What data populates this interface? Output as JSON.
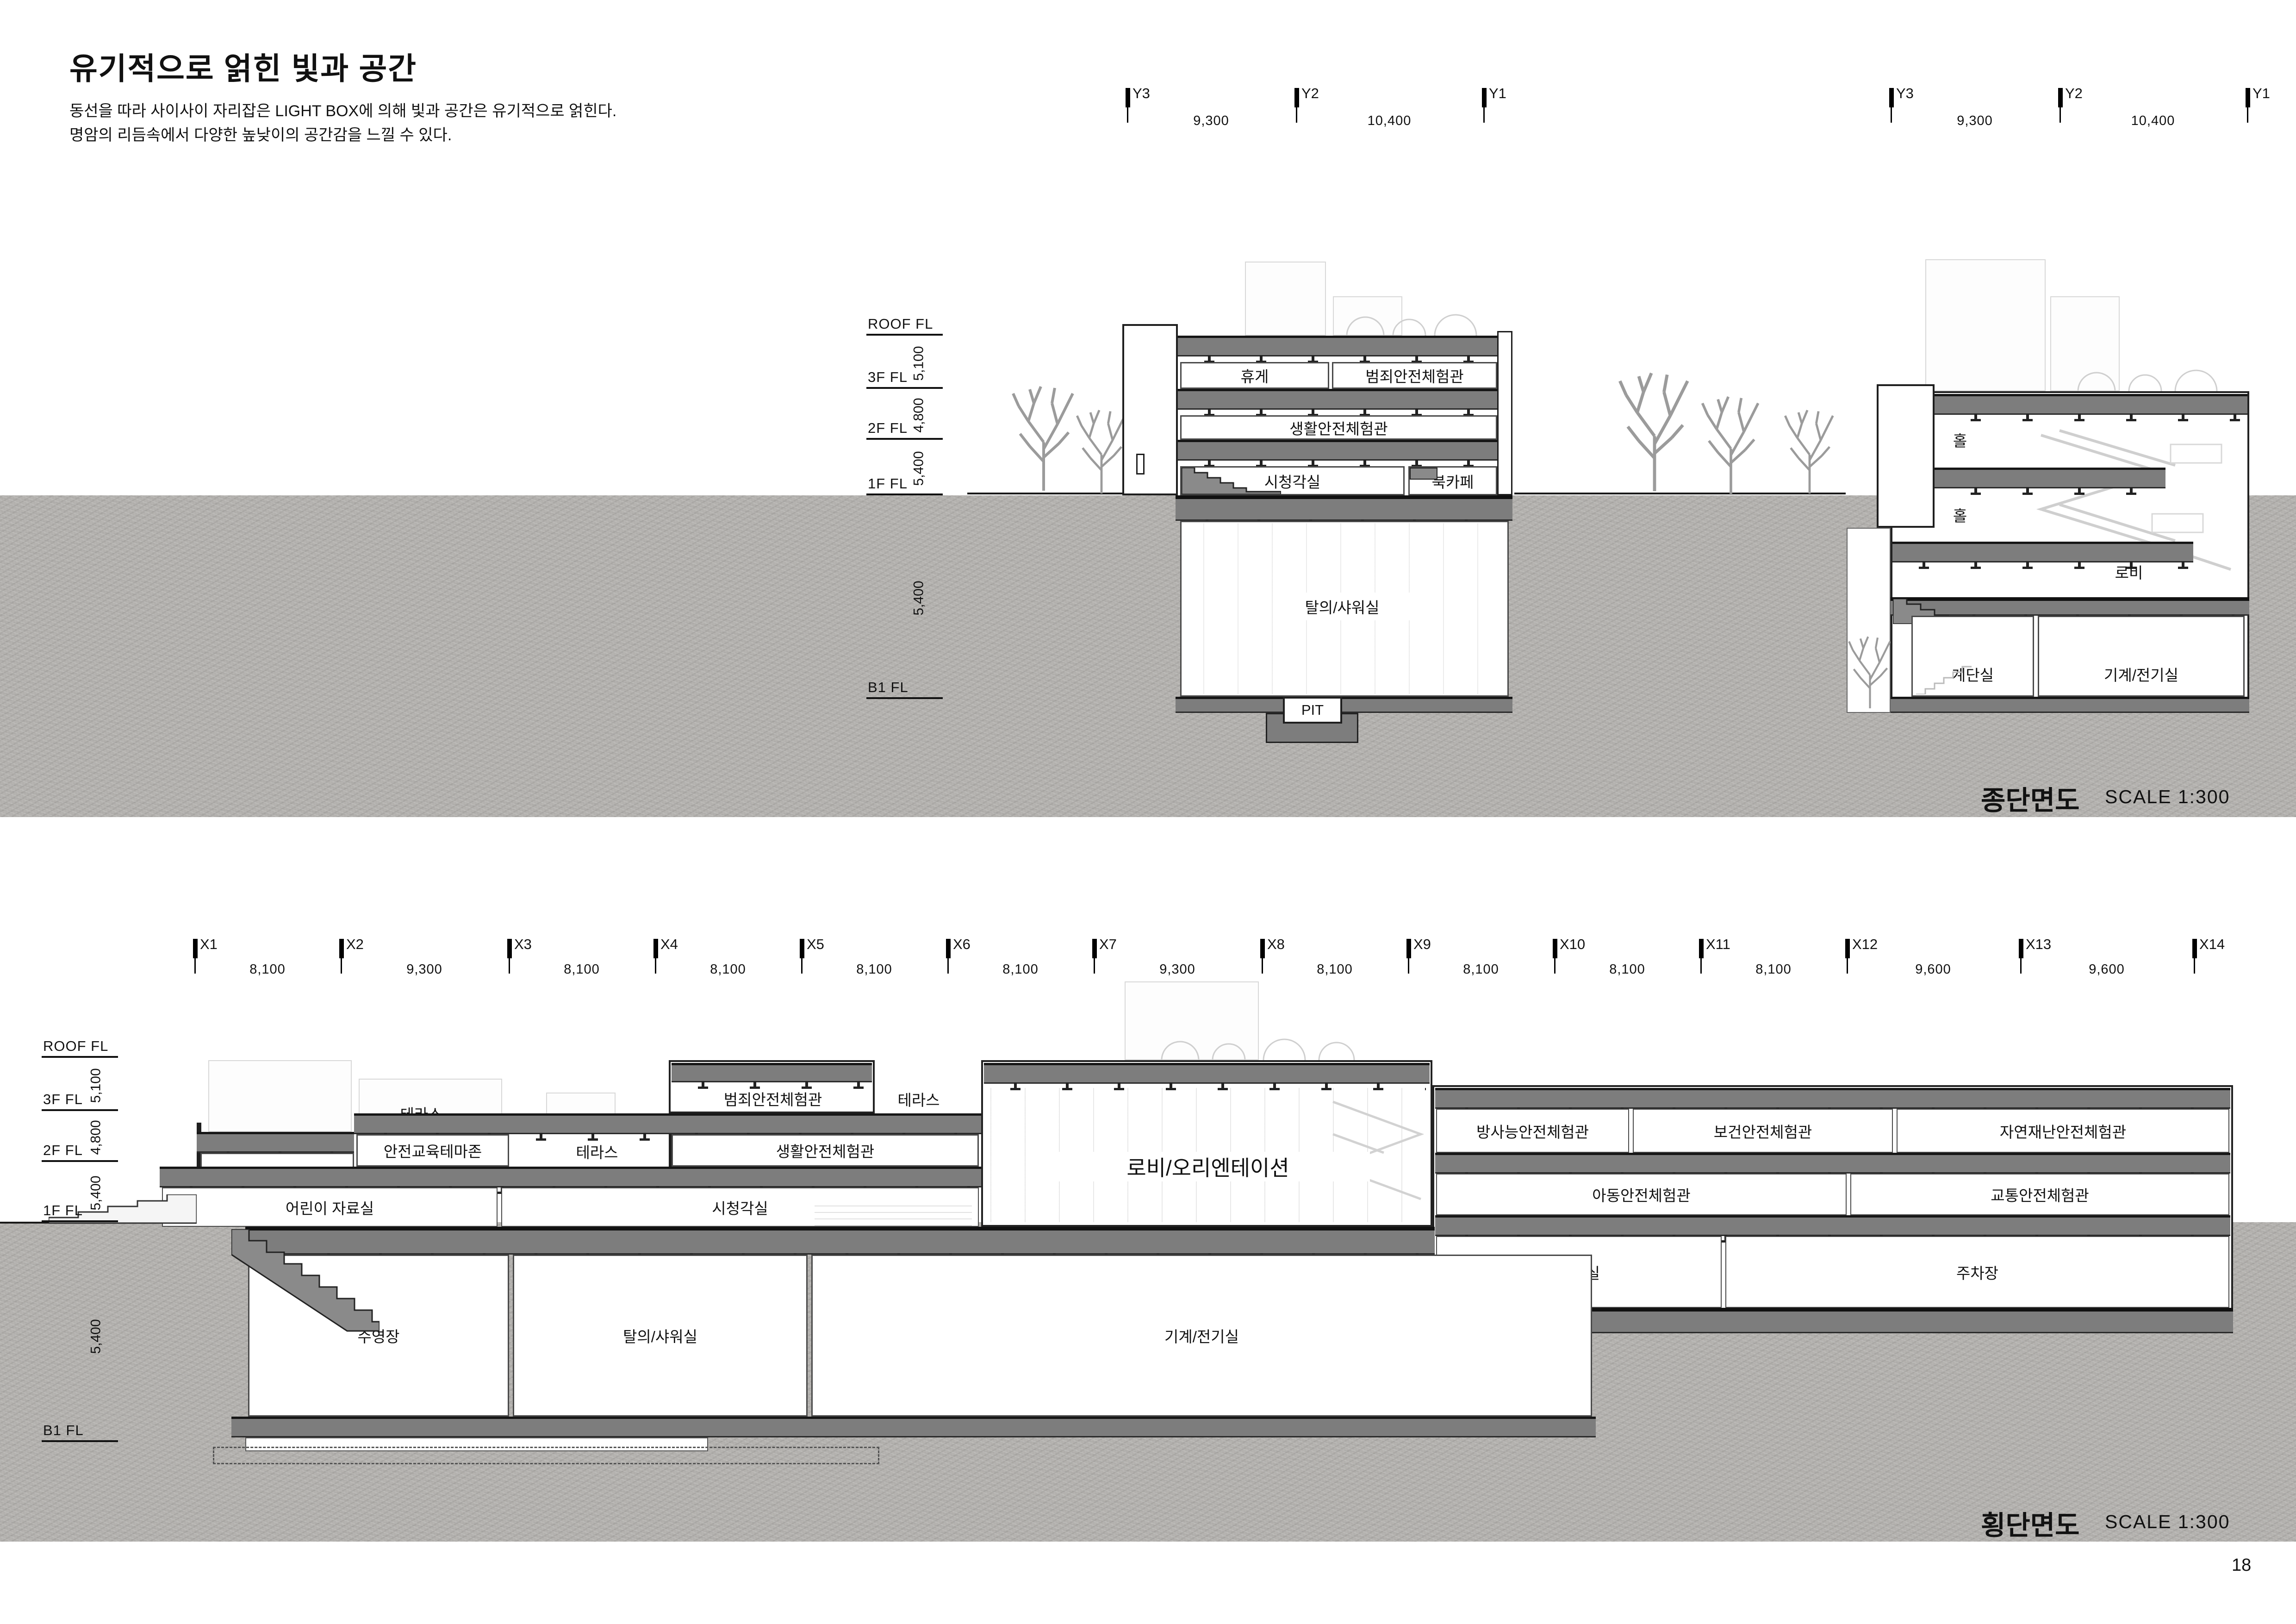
{
  "header": {
    "title": "유기적으로 얽힌 빛과 공간",
    "line1": "동선을 따라 사이사이 자리잡은 LIGHT BOX에 의해 빛과 공간은 유기적으로 얽힌다.",
    "line2": "명암의 리듬속에서 다양한 높낮이의 공간감을 느낄 수 있다."
  },
  "levels": {
    "names": [
      "ROOF FL",
      "3F FL",
      "2F FL",
      "1F FL",
      "B1 FL"
    ],
    "dims": [
      "5,100",
      "4,800",
      "5,400",
      "5,400"
    ]
  },
  "long": {
    "title": "종단면도",
    "scale": "SCALE 1:300",
    "grid": {
      "cols": [
        "Y3",
        "Y2",
        "Y1"
      ],
      "dims": [
        "9,300",
        "10,400"
      ]
    },
    "roomsA": {
      "rest": "휴게",
      "crime": "범죄안전체험관",
      "life": "생활안전체험관",
      "av": "시청각실",
      "bookcafe": "북카페",
      "shower": "탈의/샤워실",
      "pit": "PIT"
    },
    "roomsB": {
      "hall_upper": "홀",
      "hall_lower": "홀",
      "lobby": "로비",
      "stair": "계단실",
      "mech": "기계/전기실"
    }
  },
  "cross": {
    "title": "횡단면도",
    "scale": "SCALE 1:300",
    "grid": {
      "cols": [
        "X1",
        "X2",
        "X3",
        "X4",
        "X5",
        "X6",
        "X7",
        "X8",
        "X9",
        "X10",
        "X11",
        "X12",
        "X13",
        "X14"
      ],
      "dims": [
        "8,100",
        "9,300",
        "8,100",
        "8,100",
        "8,100",
        "8,100",
        "9,300",
        "8,100",
        "8,100",
        "8,100",
        "8,100",
        "9,600",
        "9,600"
      ]
    },
    "rooms": {
      "terrace_3f": "테라스",
      "crime": "범죄안전체험관",
      "terrace_3f_r": "테라스",
      "radiation": "방사능안전체험관",
      "health": "보건안전체험관",
      "disaster": "자연재난안전체험관",
      "library": "도서관",
      "edu_zone": "안전교육테마존",
      "terrace_2f": "테라스",
      "life": "생활안전체험관",
      "child": "아동안전체험관",
      "traffic": "교통안전체험관",
      "kids_room": "어린이 자료실",
      "av": "시청각실",
      "lobby": "로비/오리엔테이션",
      "office": "사무실",
      "parking": "주차장",
      "pool": "수영장",
      "shower": "탈의/샤워실",
      "mech": "기계/전기실"
    }
  },
  "page_number": "18"
}
